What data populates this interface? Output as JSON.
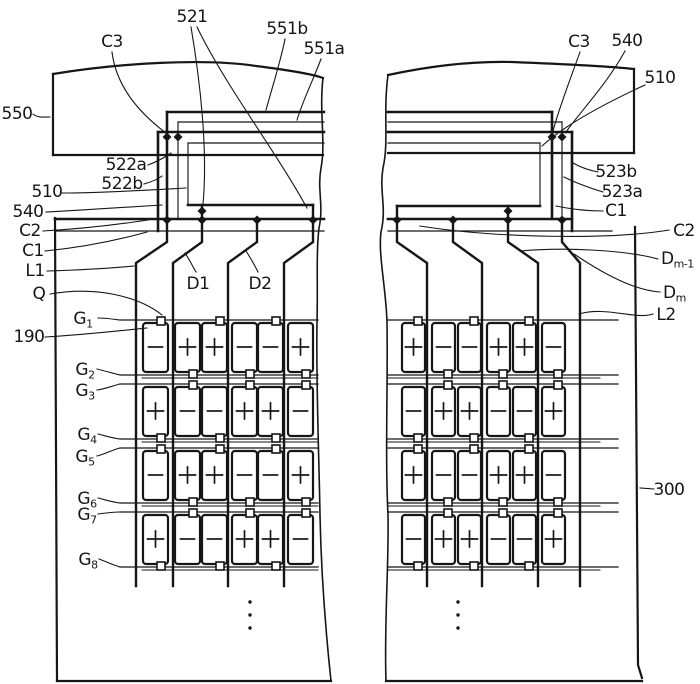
{
  "figure": {
    "kind": "patent-display-panel-diagram",
    "ink_color": "#161616",
    "background_color": "#ffffff",
    "labels": [
      {
        "id": "550",
        "text": "550",
        "x": 17,
        "y": 119,
        "anchor": "middle"
      },
      {
        "id": "521",
        "text": "521",
        "x": 192,
        "y": 22,
        "anchor": "middle"
      },
      {
        "id": "c3-left",
        "text": "C3",
        "x": 112,
        "y": 47,
        "anchor": "middle"
      },
      {
        "id": "551b",
        "text": "551b",
        "x": 287,
        "y": 34,
        "anchor": "middle"
      },
      {
        "id": "551a",
        "text": "551a",
        "x": 324,
        "y": 54,
        "anchor": "middle"
      },
      {
        "id": "522a",
        "text": "522a",
        "x": 126,
        "y": 170,
        "anchor": "middle"
      },
      {
        "id": "522b",
        "text": "522b",
        "x": 122,
        "y": 189,
        "anchor": "middle"
      },
      {
        "id": "510-left",
        "text": "510",
        "x": 47,
        "y": 197,
        "anchor": "middle"
      },
      {
        "id": "540-left",
        "text": "540",
        "x": 28,
        "y": 217,
        "anchor": "middle"
      },
      {
        "id": "c2-left",
        "text": "C2",
        "x": 30,
        "y": 236,
        "anchor": "middle"
      },
      {
        "id": "c1-left",
        "text": "C1",
        "x": 33,
        "y": 256,
        "anchor": "middle"
      },
      {
        "id": "l1",
        "text": "L1",
        "x": 35,
        "y": 276,
        "anchor": "middle"
      },
      {
        "id": "q",
        "text": "Q",
        "x": 39,
        "y": 299,
        "anchor": "middle"
      },
      {
        "id": "190",
        "text": "190",
        "x": 29,
        "y": 342,
        "anchor": "middle"
      },
      {
        "id": "g1",
        "text": "G",
        "sub": "1",
        "x": 83,
        "y": 324,
        "anchor": "middle"
      },
      {
        "id": "g2",
        "text": "G",
        "sub": "2",
        "x": 85,
        "y": 375,
        "anchor": "middle"
      },
      {
        "id": "g3",
        "text": "G",
        "sub": "3",
        "x": 85,
        "y": 396,
        "anchor": "middle"
      },
      {
        "id": "g4",
        "text": "G",
        "sub": "4",
        "x": 87,
        "y": 440,
        "anchor": "middle"
      },
      {
        "id": "g5",
        "text": "G",
        "sub": "5",
        "x": 85,
        "y": 462,
        "anchor": "middle"
      },
      {
        "id": "g6",
        "text": "G",
        "sub": "6",
        "x": 87,
        "y": 504,
        "anchor": "middle"
      },
      {
        "id": "g7",
        "text": "G",
        "sub": "7",
        "x": 87,
        "y": 520,
        "anchor": "middle"
      },
      {
        "id": "g8",
        "text": "G",
        "sub": "8",
        "x": 88,
        "y": 565,
        "anchor": "middle"
      },
      {
        "id": "d1",
        "text": "D1",
        "x": 198,
        "y": 289,
        "anchor": "middle"
      },
      {
        "id": "d2",
        "text": "D2",
        "x": 260,
        "y": 289,
        "anchor": "middle"
      },
      {
        "id": "c3-right",
        "text": "C3",
        "x": 579,
        "y": 47,
        "anchor": "middle"
      },
      {
        "id": "540-right",
        "text": "540",
        "x": 627,
        "y": 46,
        "anchor": "middle"
      },
      {
        "id": "510-right",
        "text": "510",
        "x": 660,
        "y": 83,
        "anchor": "middle"
      },
      {
        "id": "523b",
        "text": "523b",
        "x": 616,
        "y": 177,
        "anchor": "middle"
      },
      {
        "id": "523a",
        "text": "523a",
        "x": 622,
        "y": 197,
        "anchor": "middle"
      },
      {
        "id": "c1-right",
        "text": "C1",
        "x": 616,
        "y": 216,
        "anchor": "middle"
      },
      {
        "id": "c2-right",
        "text": "C2",
        "x": 684,
        "y": 236,
        "anchor": "middle"
      },
      {
        "id": "dm-1",
        "text": "D",
        "sub": "m-1",
        "x": 661,
        "y": 264,
        "anchor": "start"
      },
      {
        "id": "dm",
        "text": "D",
        "sub": "m",
        "x": 663,
        "y": 298,
        "anchor": "start"
      },
      {
        "id": "l2",
        "text": "L2",
        "x": 666,
        "y": 320,
        "anchor": "middle"
      },
      {
        "id": "300",
        "text": "300",
        "x": 669,
        "y": 495,
        "anchor": "middle"
      }
    ],
    "pixel_arrays": {
      "left": {
        "rows": 4,
        "cols": 6,
        "signs": [
          [
            "-",
            "+",
            "+",
            "-",
            "-",
            "+"
          ],
          [
            "+",
            "-",
            "-",
            "+",
            "+",
            "-"
          ],
          [
            "-",
            "+",
            "+",
            "-",
            "-",
            "+"
          ],
          [
            "+",
            "-",
            "-",
            "+",
            "+",
            "-"
          ]
        ]
      },
      "right": {
        "rows": 4,
        "cols": 6,
        "signs": [
          [
            "+",
            "-",
            "-",
            "+",
            "+",
            "-"
          ],
          [
            "-",
            "+",
            "+",
            "-",
            "-",
            "+"
          ],
          [
            "+",
            "-",
            "-",
            "+",
            "+",
            "-"
          ],
          [
            "-",
            "+",
            "+",
            "-",
            "-",
            "+"
          ]
        ]
      }
    },
    "continuation_dots_per_side": 3
  }
}
